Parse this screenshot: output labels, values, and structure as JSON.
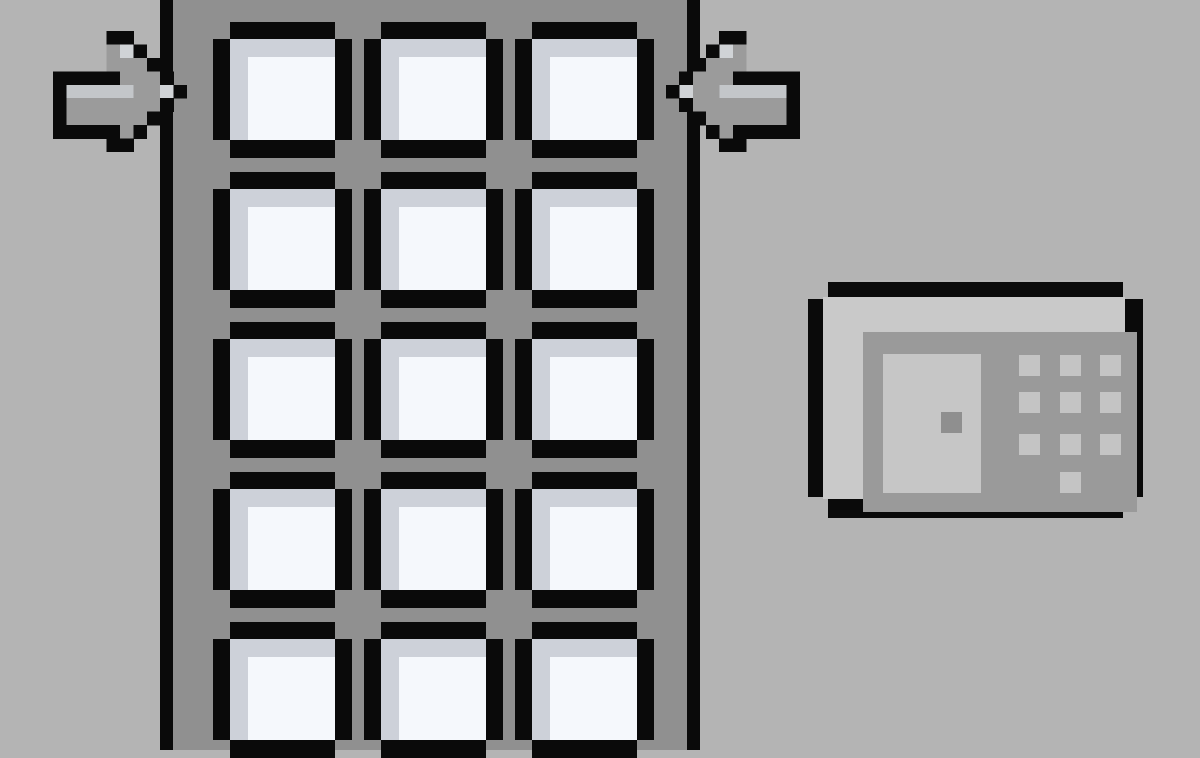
{
  "scene": {
    "description": "Pixel-art wall with a tall building door of glass windows, two arrows pointing inward at the door, and a security keypad mounted on the wall",
    "colors": {
      "background": "#b4b4b4",
      "outline": "#0a0a0a",
      "door_body": "#909090",
      "window_glass": "#f5f8fc",
      "window_glass_shade": "#cdd1d9",
      "arrow_fill": "#9b9b9b",
      "arrow_band": "#c3c6c9",
      "arrow_highlight": "#d0d3d6",
      "keypad_bezel": "#c9c9c9",
      "keypad_panel": "#9a9a9a",
      "keypad_display": "#c6c6c6",
      "keypad_cursor": "#8f8f8f",
      "keypad_button": "#c4c4c4"
    }
  },
  "door": {
    "window_rows": 5,
    "window_columns": 3,
    "window_count_visible": 15
  },
  "arrows": {
    "left": {
      "icon": "pixel-arrow-right-icon",
      "direction": "right",
      "points_at": "door"
    },
    "right": {
      "icon": "pixel-arrow-left-icon",
      "direction": "left",
      "points_at": "door"
    }
  },
  "keypad": {
    "display": {
      "content": "",
      "cursor_visible": true
    },
    "buttons": {
      "grid_rows": 3,
      "grid_columns": 3,
      "extra_bottom_center_button": 1,
      "total": 10,
      "labels_visible": false
    }
  }
}
